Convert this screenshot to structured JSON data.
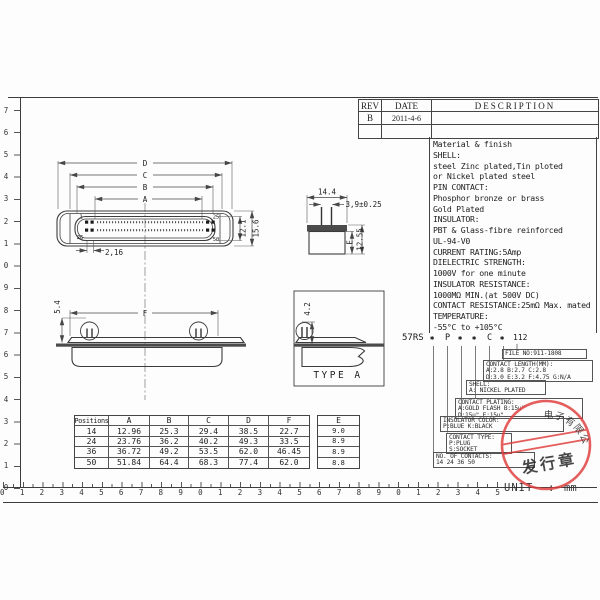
{
  "rev_table": {
    "headers": [
      "REV",
      "DATE",
      "DESCRIPTION"
    ],
    "rows": [
      [
        "B",
        "2011-4-6",
        ""
      ],
      [
        "",
        "",
        ""
      ]
    ]
  },
  "specs": {
    "lines": [
      "Material & finish",
      "SHELL:",
      "steel Zinc plated,Tin ploted",
      "or Nickel plated steel",
      "PIN CONTACT:",
      "Phosphor bronze or brass",
      "Gold Plated",
      "INSULATOR:",
      "PBT & Glass-fibre reinforced",
      "UL-94-V0",
      "CURRENT RATING:5Amp",
      "DIELECTRIC STRENGTH:",
      "1000V for one minute",
      "INSULATOR RESISTANCE:",
      "1000MΩ MIN.(at 500V DC)",
      "CONTACT RESISTANCE:25mΩ Max. mated",
      "TEMPERATURE:",
      "-55°C to +105°C"
    ]
  },
  "part_number": {
    "prefix": "57RS",
    "fields": [
      "✱",
      "P",
      "✱",
      "✱",
      "C",
      "✱"
    ],
    "suffix": "112",
    "file_no": {
      "title": "FILE NO:911-1808"
    },
    "contact_length": {
      "title": "CONTACT LENGTH(MM):",
      "line1": "A:2.8  B:2.7  C:2.8",
      "line2": "D:3.0  E:3.2  F:4.75  G:N/A"
    },
    "shell": {
      "title": "SHELL:",
      "line1": "A: NICKEL PLATED"
    },
    "contact_plating": {
      "title": "CONTACT PLATING:",
      "line1": "A:GOLD FLASH  B:15u\"",
      "line2": "D:15u\"  E:15u\""
    },
    "insulator_color": {
      "title": "INSULATOR COLOR:",
      "line1": "P:BLUE  K:BLACK"
    },
    "contact_type": {
      "title": "CONTACT TYPE:",
      "line1": "P:PLUG",
      "line2": "S:SOCKET"
    },
    "no_of_contacts": {
      "title": "NO. OF CONTACTS:",
      "line1": "14 24 36 50"
    }
  },
  "positions_table": {
    "headers": [
      "Positions",
      "A",
      "B",
      "C",
      "D",
      "F",
      "E"
    ],
    "rows": [
      [
        "14",
        "12.96",
        "25.3",
        "29.4",
        "38.5",
        "22.7",
        "9.0"
      ],
      [
        "24",
        "23.76",
        "36.2",
        "40.2",
        "49.3",
        "33.5",
        "8.9"
      ],
      [
        "36",
        "36.72",
        "49.2",
        "53.5",
        "62.0",
        "46.45",
        "8.9"
      ],
      [
        "50",
        "51.84",
        "64.4",
        "68.3",
        "77.4",
        "62.0",
        "8.8"
      ]
    ]
  },
  "front_view": {
    "dim_d": "D",
    "dim_c": "C",
    "dim_b": "B",
    "dim_a": "A",
    "height_inner": "12.1",
    "height_outer": "15.6",
    "pitch": "2,16",
    "pin1": "1",
    "pin25": "25",
    "pin26": "26",
    "pin50": "50"
  },
  "side_view": {
    "width": "14.4",
    "pin_pitch": "3,9±0.25",
    "dim_e": "E",
    "height": "12.55"
  },
  "profile_view": {
    "pin_height": "5.4",
    "dim_f": "F"
  },
  "type_a": {
    "pin_height": "4.2",
    "label": "TYPE A"
  },
  "stamp": {
    "arc_text": "电子有限公司",
    "main_text": "发行章",
    "color": "#e03c3c"
  },
  "unit": {
    "label": "UNIT",
    "sep": ":",
    "value": "mm"
  },
  "rulers": {
    "bottom": [
      "0",
      "1",
      "2",
      "3",
      "4",
      "5",
      "6",
      "7",
      "8",
      "9",
      "0",
      "1",
      "2",
      "3",
      "4",
      "5",
      "6",
      "7",
      "8",
      "9",
      "0",
      "1",
      "2",
      "3",
      "4",
      "5"
    ],
    "left": [
      "7",
      "6",
      "5",
      "4",
      "3",
      "2",
      "1",
      "0",
      "9",
      "8",
      "7",
      "6",
      "5",
      "4",
      "3",
      "2",
      "1",
      "0"
    ]
  }
}
